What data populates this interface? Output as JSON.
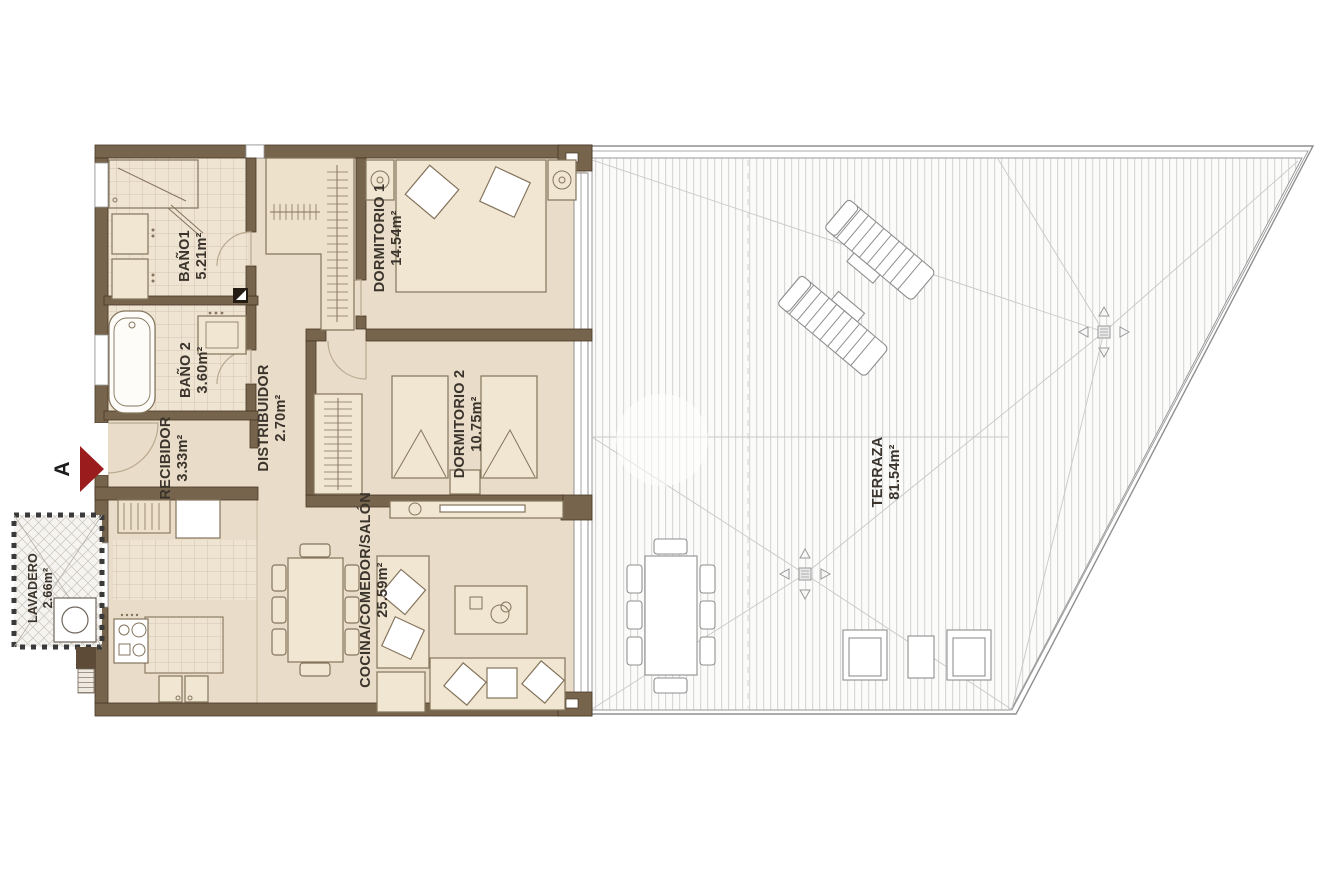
{
  "plan": {
    "type": "apartment-floor-plan",
    "language": "es",
    "section_marker": {
      "label": "A"
    },
    "rooms": [
      {
        "id": "bano1",
        "name": "BAÑO1",
        "area": "5.21m²"
      },
      {
        "id": "bano2",
        "name": "BAÑO 2",
        "area": "3.60m²"
      },
      {
        "id": "recibidor",
        "name": "RECIBIDOR",
        "area": "3.33m²"
      },
      {
        "id": "distribuidor",
        "name": "DISTRIBUIDOR",
        "area": "2.70m²"
      },
      {
        "id": "dormitorio1",
        "name": "DORMITORIO 1",
        "area": "14.54m²"
      },
      {
        "id": "dormitorio2",
        "name": "DORMITORIO 2",
        "area": "10.75m²"
      },
      {
        "id": "cocina",
        "name": "COCINA/COMEDOR/SALÓN",
        "area": "25.59m²"
      },
      {
        "id": "lavadero",
        "name": "LAVADERO",
        "area": "2.66m²"
      },
      {
        "id": "terraza",
        "name": "TERRAZA",
        "area": "81.54m²"
      }
    ],
    "colors": {
      "wall": "#77644c",
      "floor": "#e9dcc8",
      "tile_line": "#cdbca6",
      "terrace_stripe": "#d9d9d9",
      "marker_red": "#9b1c1c",
      "label_text": "#3b342c"
    }
  }
}
